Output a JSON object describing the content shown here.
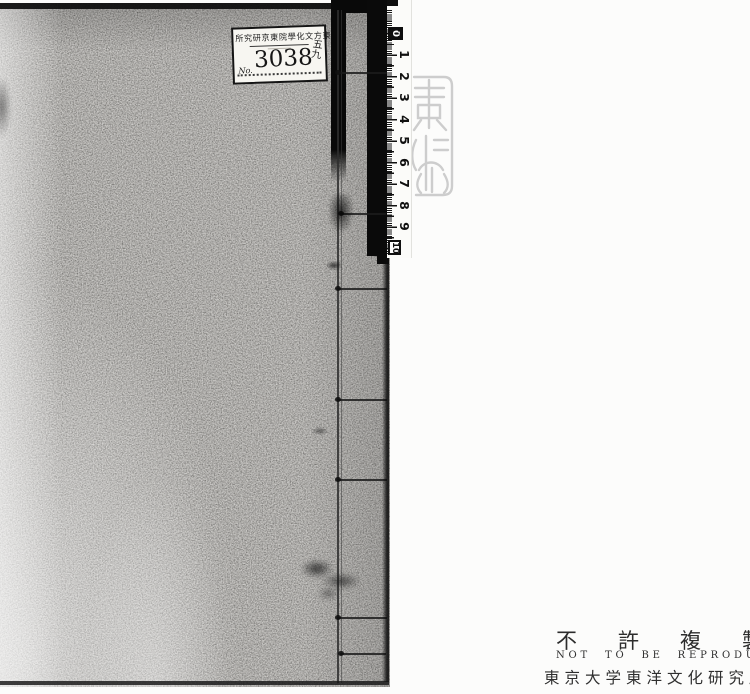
{
  "label": {
    "institution": "所究研京東院學化文方東",
    "no_prefix": "No.",
    "number": "3038",
    "annotation_top": "五",
    "annotation_bottom": "九"
  },
  "ruler": {
    "unit": "cm",
    "numbers": [
      "0",
      "1",
      "2",
      "3",
      "4",
      "5",
      "6",
      "7",
      "8",
      "9",
      "10"
    ]
  },
  "footer": {
    "notice_ja": "不許複製",
    "notice_en": "NOT TO BE REPRODUCED",
    "institution_ja": "東京大学東洋文化研究所"
  },
  "colors": {
    "cover_gray": "#b5b3af",
    "background": "#fcfcfb",
    "ink": "#1a1a1a",
    "seal_gray": "#c5c5c5"
  }
}
